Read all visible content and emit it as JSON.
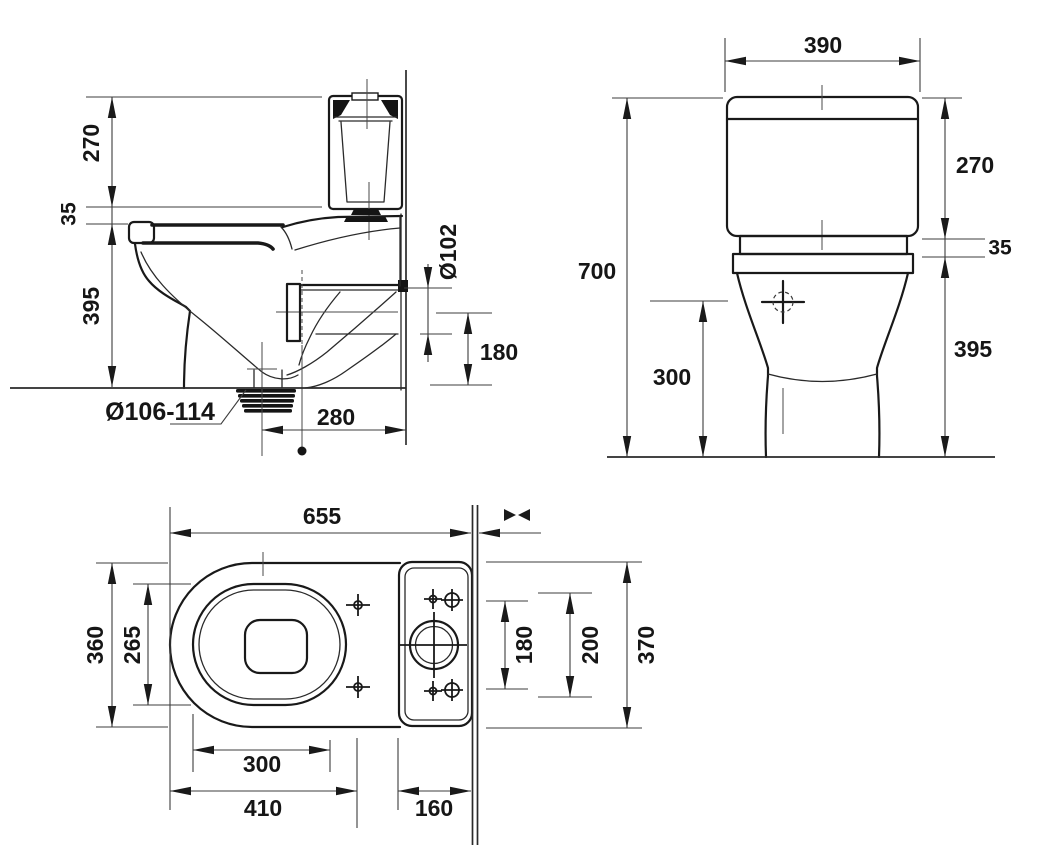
{
  "drawing": {
    "background_color": "#ffffff",
    "line_color": "#191919",
    "views": {
      "side": {
        "name": "side section view",
        "dims": {
          "cistern_height": "270",
          "seat_gap": "35",
          "bowl_height": "395",
          "outlet_diameter": "Ø106-114",
          "outlet_to_wall": "280",
          "pipe_diameter": "Ø102",
          "pipe_height": "180"
        }
      },
      "front": {
        "name": "front view",
        "dims": {
          "cistern_width": "390",
          "overall_height": "700",
          "cistern_height": "270",
          "coupling_gap": "35",
          "bowl_height": "395",
          "inlet_height": "300"
        }
      },
      "plan": {
        "name": "top view",
        "dims": {
          "overall_depth": "655",
          "bowl_width": "360",
          "seat_width": "265",
          "opening_length": "300",
          "bowl_length": "410",
          "cistern_depth": "160",
          "holes_spacing": "180",
          "outer_holes_spacing": "200",
          "cistern_width": "370"
        }
      }
    }
  }
}
